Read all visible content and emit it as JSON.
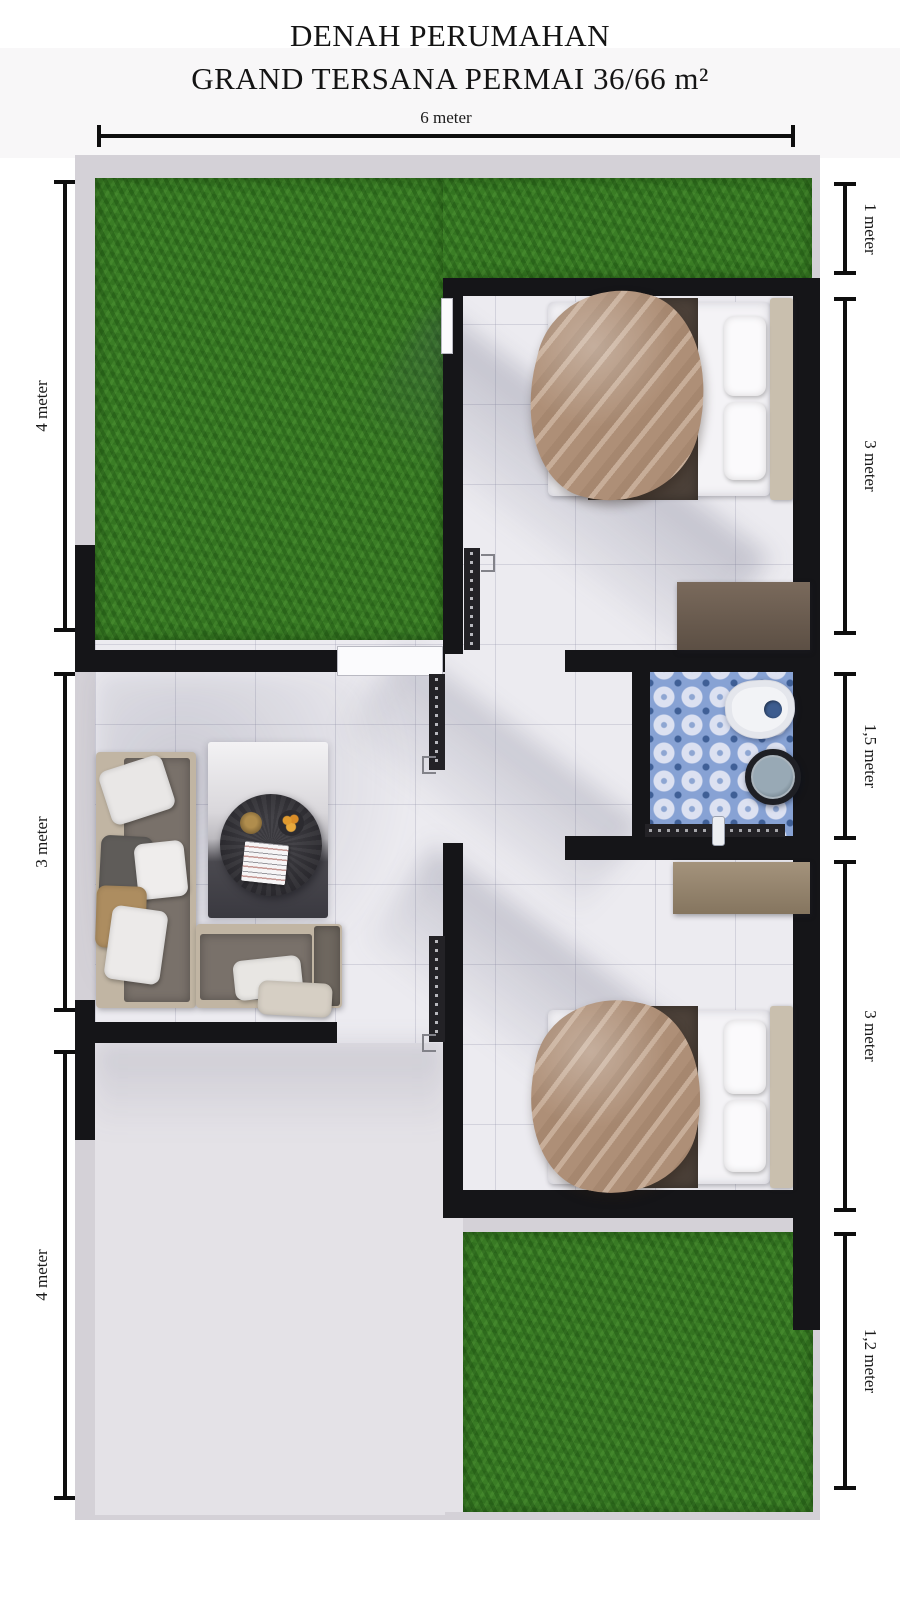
{
  "header": {
    "line1": "DENAH PERUMAHAN",
    "line2": "GRAND TERSANA PERMAI 36/66 m²"
  },
  "dimensions": {
    "top": {
      "label": "6 meter"
    },
    "left": [
      {
        "label": "4 meter"
      },
      {
        "label": "3 meter"
      },
      {
        "label": "4 meter"
      }
    ],
    "right": [
      {
        "label": "1 meter"
      },
      {
        "label": "3 meter"
      },
      {
        "label": "1,5 meter"
      },
      {
        "label": "3 meter"
      },
      {
        "label": "1,2 meter"
      }
    ]
  },
  "colors": {
    "grass": "#3a7d25",
    "wall": "#151518",
    "bathroom_tile": "#87a2d4",
    "plot_border": "#d4d1d7",
    "floor": "#ecebf0",
    "terrace": "#e4e2e7"
  }
}
